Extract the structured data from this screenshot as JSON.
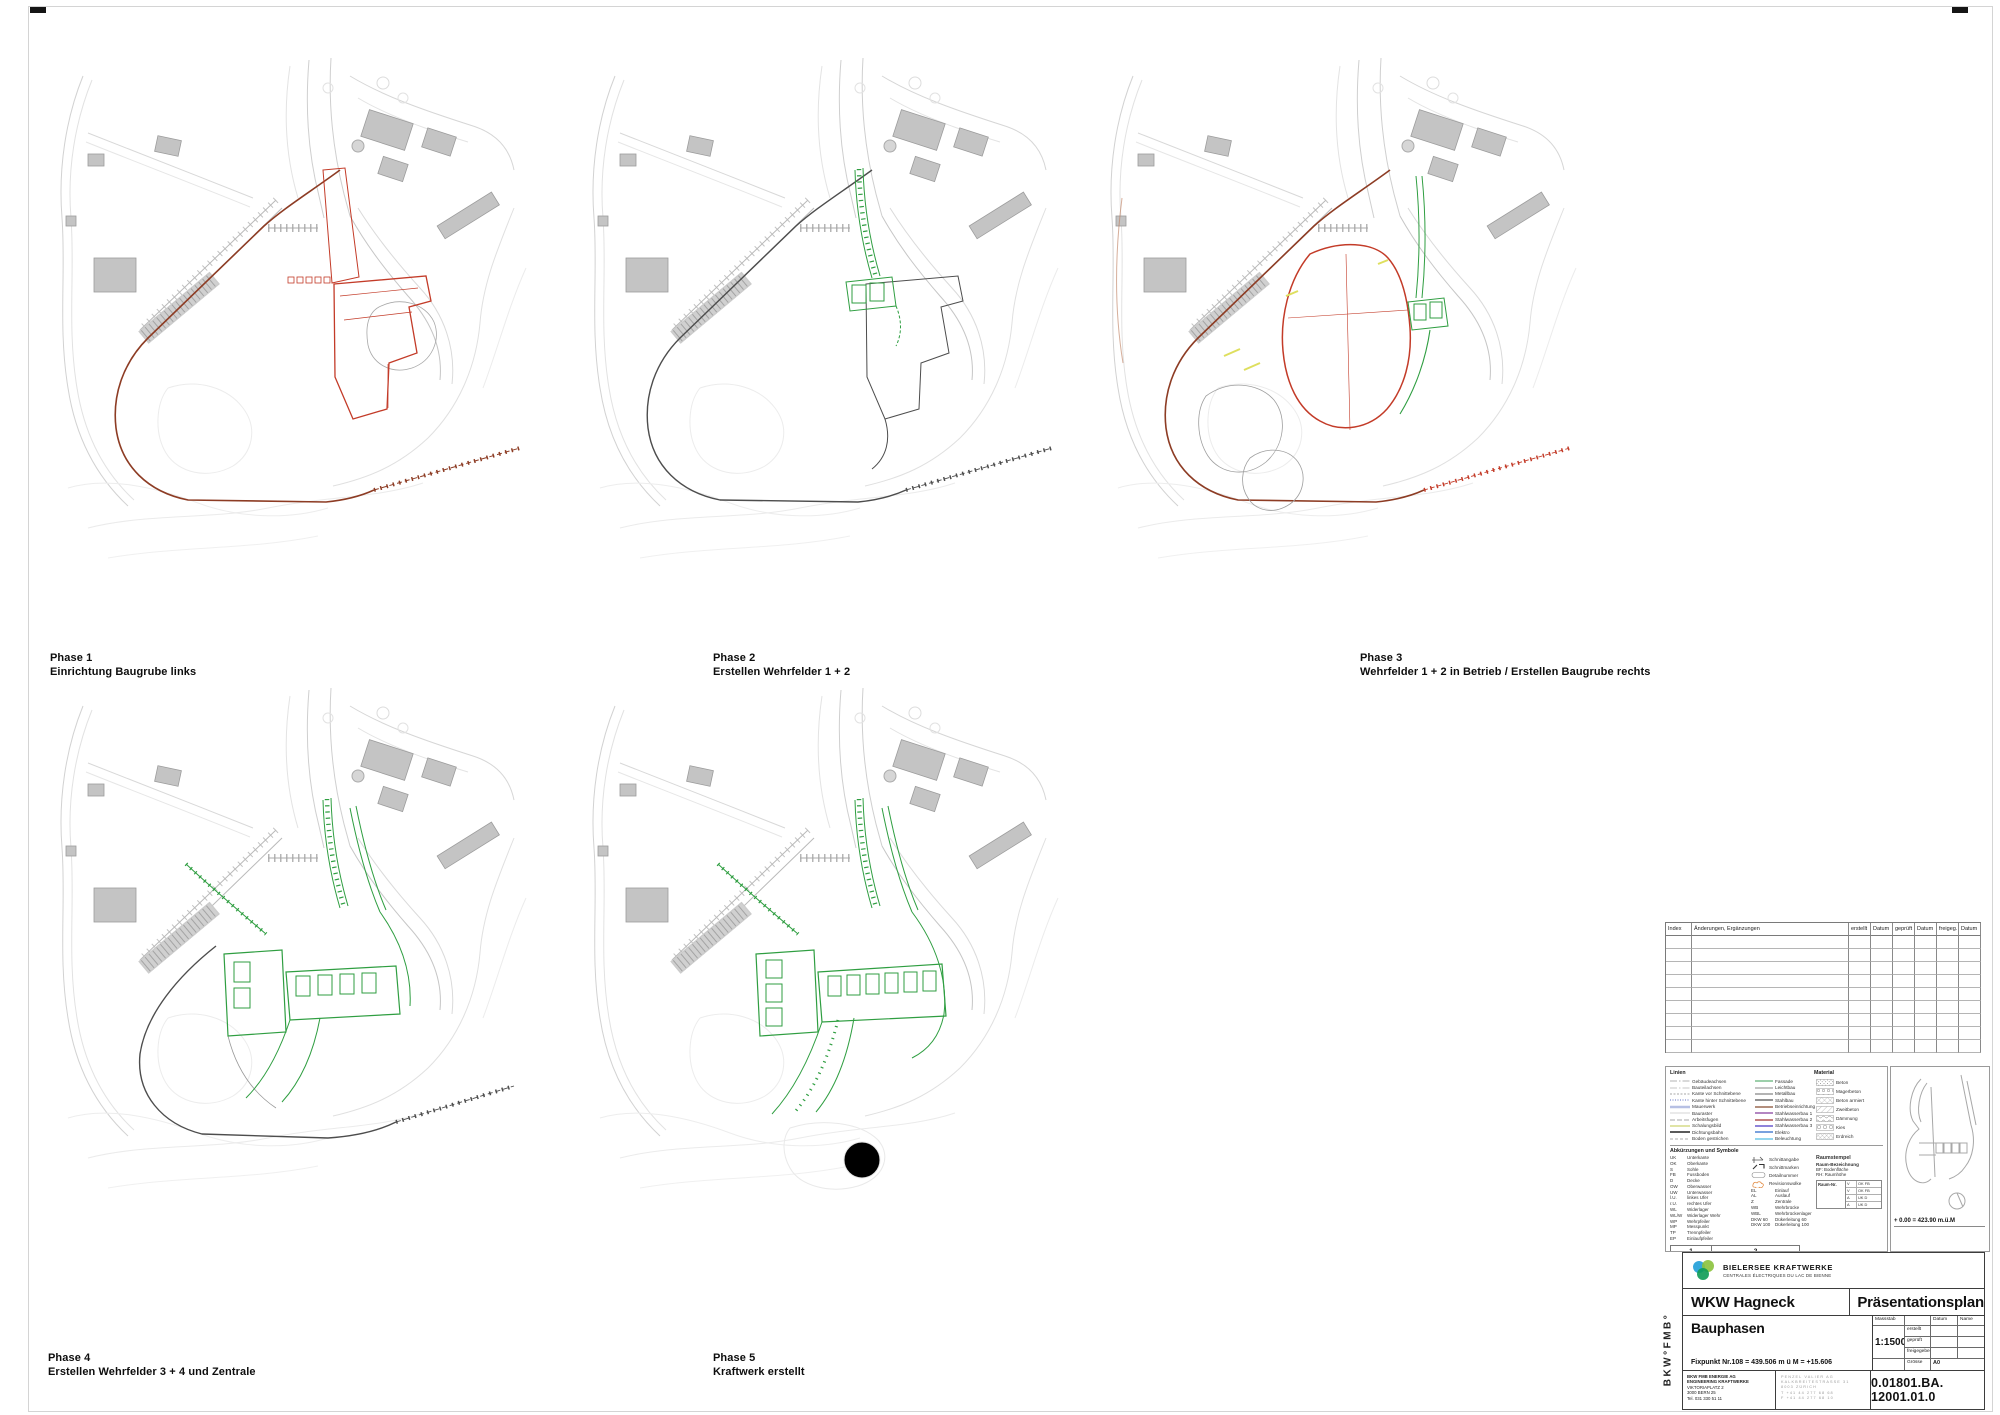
{
  "phases": [
    {
      "title": "Phase 1",
      "subtitle": "Einrichtung Baugrube links"
    },
    {
      "title": "Phase 2",
      "subtitle": "Erstellen Wehrfelder 1 + 2"
    },
    {
      "title": "Phase 3",
      "subtitle": "Wehrfelder 1 + 2 in Betrieb / Erstellen Baugrube rechts"
    },
    {
      "title": "Phase 4",
      "subtitle": "Erstellen Wehrfelder 3 + 4 und Zentrale"
    },
    {
      "title": "Phase 5",
      "subtitle": "Kraftwerk erstellt"
    }
  ],
  "colors": {
    "construction_red": "#c33b28",
    "construction_red_fill": "#f1ded7",
    "cofferdam_brown": "#8d3c24",
    "built_green": "#2f9e41",
    "neutral_dark": "#4d4d4d",
    "yellow_accent": "#dedf5e",
    "logo_blue": "#35a8dc",
    "logo_green": "#8bc23c",
    "logo_teal": "#0d9b55"
  },
  "revision_table": {
    "headers": [
      "Index",
      "Änderungen, Ergänzungen",
      "erstellt",
      "Datum",
      "geprüft",
      "Datum",
      "freigeg.",
      "Datum"
    ],
    "empty_rows": 9
  },
  "legend": {
    "section1": {
      "left_header": "Linien",
      "right_header": "Material",
      "lines_a": [
        {
          "label": "Gebäudeachsen",
          "color": "#9a9a9a",
          "dash": "7 2 1.5 2",
          "width": 0.8
        },
        {
          "label": "Bauteilachsen",
          "color": "#b5b5b5",
          "dash": "7 2 1.5 2",
          "width": 0.8
        },
        {
          "label": "Kante vor Schnittebene",
          "color": "#8a8a8a",
          "dash": "2 1.5",
          "width": 0.8
        },
        {
          "label": "Kante hinter Schnittebene",
          "color": "#5f6fc0",
          "dash": "1 1.5",
          "width": 1
        },
        {
          "label": "Mauerwerk",
          "color": "#b7c0e4",
          "dash": "",
          "width": 2.6
        },
        {
          "label": "Bauraster",
          "color": "#c9c9c9",
          "dash": "",
          "width": 0.8
        },
        {
          "label": "Arbeitsfugen",
          "color": "#8a8a8a",
          "dash": "5 2",
          "width": 0.8
        },
        {
          "label": "Schalungsbild",
          "color": "#cdd470",
          "dash": "",
          "width": 1.2
        },
        {
          "label": "Dichtungsbahn",
          "color": "#5a5a5a",
          "dash": "",
          "width": 2
        },
        {
          "label": "Boden gestrichen",
          "color": "#adadad",
          "dash": "3 2",
          "width": 1
        }
      ],
      "lines_b": [
        {
          "label": "Fassade",
          "color": "#7cbf8e"
        },
        {
          "label": "Leichtbau",
          "color": "#b0b0b0"
        },
        {
          "label": "Metallbau",
          "color": "#9a9a9a"
        },
        {
          "label": "Stahlbau",
          "color": "#6e6e6e"
        },
        {
          "label": "Betriebseinrichtungen",
          "color": "#9a6a52"
        },
        {
          "label": "Stahlwasserbau 1",
          "color": "#9a5fae"
        },
        {
          "label": "Stahlwasserbau 2",
          "color": "#b05555"
        },
        {
          "label": "Stahlwasserbau 3",
          "color": "#6a5ace"
        },
        {
          "label": "Elektro",
          "color": "#4f82d4"
        },
        {
          "label": "Beleuchtung",
          "color": "#72c9e8"
        }
      ],
      "materials": [
        {
          "label": "Beton",
          "pattern": "dots"
        },
        {
          "label": "Magerbeton",
          "pattern": "circles"
        },
        {
          "label": "Beton armiert",
          "pattern": "cross"
        },
        {
          "label": "Zweitbeton",
          "pattern": "diag"
        },
        {
          "label": "Dämmung",
          "pattern": "wave"
        },
        {
          "label": "Kies",
          "pattern": "circles2"
        },
        {
          "label": "Erdreich",
          "pattern": "cross2"
        }
      ]
    },
    "section2": {
      "header": "Abkürzungen und Symbole",
      "abbrev_col1": [
        [
          "UK",
          "Unterkante"
        ],
        [
          "OK",
          "Oberkante"
        ],
        [
          "S",
          "Sohle"
        ],
        [
          "FB",
          "Fussboden"
        ],
        [
          "D",
          "Decke"
        ],
        [
          "OW",
          "Oberwasser"
        ],
        [
          "UW",
          "Unterwasser"
        ],
        [
          "l.U.",
          "linkes Ufer"
        ],
        [
          "r.U.",
          "rechtes Ufer"
        ],
        [
          "WL",
          "Widerlager"
        ],
        [
          "WL/W",
          "Widerlager Wehr"
        ],
        [
          "WP",
          "Wehrpfeiler"
        ],
        [
          "MP",
          "Messpunkt"
        ],
        [
          "TP",
          "Trennpfeiler"
        ],
        [
          "EP",
          "Einlaufpfeiler"
        ]
      ],
      "abbrev_col2": [
        [
          "EL",
          "Einlauf"
        ],
        [
          "AL",
          "Auslauf"
        ],
        [
          "Z",
          "Zentrale"
        ],
        [
          "WB",
          "Wehrbrücke"
        ],
        [
          "WBL",
          "Wehrbrückenlager"
        ],
        [
          "DKW 60",
          "Dükerleitung 60"
        ],
        [
          "DKW 100",
          "Dükerleitung 100"
        ]
      ],
      "symbols": [
        "Schnittangabe",
        "Schnittmarken",
        "Detailnummer",
        "Revisionswolke"
      ],
      "raumstempel": {
        "header": "Raumstempel",
        "title": "Raum-Bezeichnung",
        "lines": [
          "BF:  Bodenfläche",
          "RH:  Raumhöhe"
        ],
        "room_no_label": "Raum-Nr.",
        "rows": [
          [
            "V",
            "OK FB"
          ],
          [
            "V",
            "OK FB"
          ],
          [
            "A",
            "UK D"
          ],
          [
            "A",
            "UK D"
          ]
        ]
      }
    },
    "tabs": [
      "1",
      "2"
    ]
  },
  "key_panel": {
    "datum_note": "+ 0.00 = 423.90 m.ü.M"
  },
  "title_block": {
    "logo_title": "BIELERSEE KRAFTWERKE",
    "logo_subtitle": "CENTRALES ÉLECTRIQUES DU LAC DE BIENNE",
    "project": "WKW Hagneck",
    "doc_type": "Präsentationsplan",
    "sheet_title": "Bauphasen",
    "fixpoint": "Fixpunkt Nr.108 = 439.506 m ü M = +15.606",
    "scale_label": "Massstab",
    "scale_value": "1:1500",
    "approval_cols": [
      "Datum",
      "Name"
    ],
    "approval_rows": [
      "erstellt",
      "geprüft",
      "freigegeben"
    ],
    "size_label": "Grösse",
    "size_value": "A0",
    "company_lines": [
      "BKW FMB ENERGIE AG",
      "ENGINEERING KRAFTWERKE",
      "VIKTORIAPLATZ 2",
      "3000 BERN 25",
      "Tel. 031 330 51 11"
    ],
    "consultant_lines": [
      "PENZEL VALIER AG",
      "KALKBREITESTRASSE 31",
      "8003 ZÜRICH",
      "T +41 44 277 68 68",
      "F +41 44 277 68 10"
    ],
    "drawing_number": "0.01801.BA. 12001.01.0",
    "side_label": "BKW°FMB°"
  }
}
